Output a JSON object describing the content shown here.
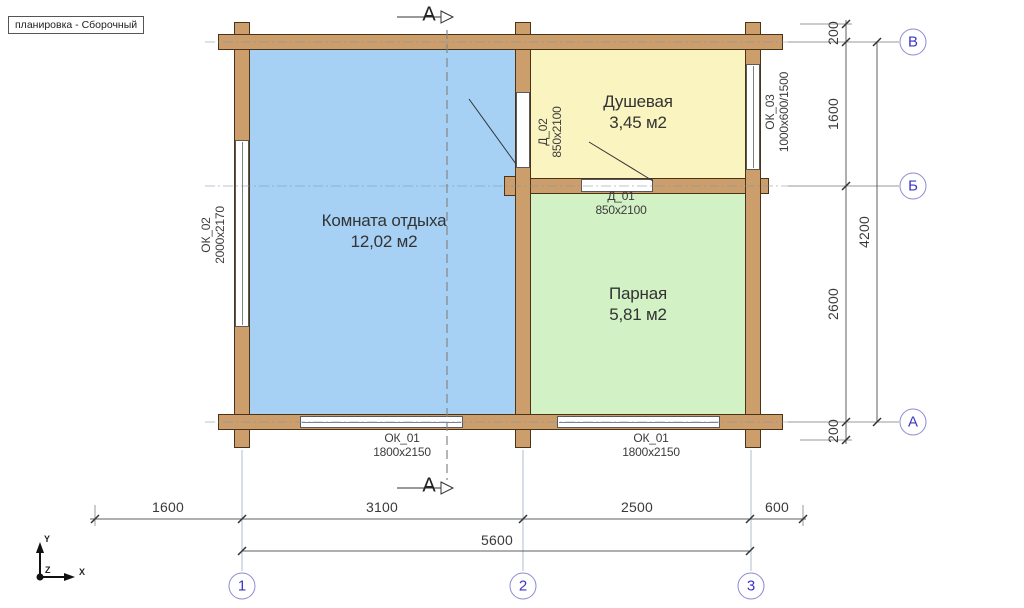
{
  "title": "планировка - Сборочный",
  "rooms": [
    {
      "name": "Комната отдыха",
      "area": "12,02 м2"
    },
    {
      "name": "Душевая",
      "area": "3,45 м2"
    },
    {
      "name": "Парная",
      "area": "5,81 м2"
    }
  ],
  "openings": {
    "ok02": {
      "label": "ОК_02",
      "size": "2000х2170"
    },
    "ok03": {
      "label": "ОК_03",
      "size": "1000х600/1500"
    },
    "ok01_left": {
      "label": "ОК_01",
      "size": "1800х2150"
    },
    "ok01_right": {
      "label": "ОК_01",
      "size": "1800х2150"
    },
    "d01": {
      "label": "Д_01",
      "size": "850х2100"
    },
    "d02": {
      "label": "Д_02",
      "size": "850х2100"
    }
  },
  "dimensions": {
    "right": [
      "200",
      "1600",
      "2600",
      "200"
    ],
    "right_total": "4200",
    "bottom": [
      "1600",
      "3100",
      "2500",
      "600"
    ],
    "bottom_total": "5600"
  },
  "axes_marks": {
    "rows": [
      "В",
      "Б",
      "А"
    ],
    "cols": [
      "1",
      "2",
      "3"
    ]
  },
  "section": {
    "label": "А"
  },
  "ucs": {
    "x": "X",
    "y": "Y",
    "z": "Z"
  },
  "colors": {
    "wood": "#cb9e6b",
    "wood_outline": "#4a3318",
    "room_rest": "#a6d1f4",
    "room_shower": "#faf5c0",
    "room_steam": "#d2f1c4",
    "axis_bubble_stroke": "#8a8ad4",
    "axis_text": "#3a35c4",
    "line_gray": "#555555"
  }
}
